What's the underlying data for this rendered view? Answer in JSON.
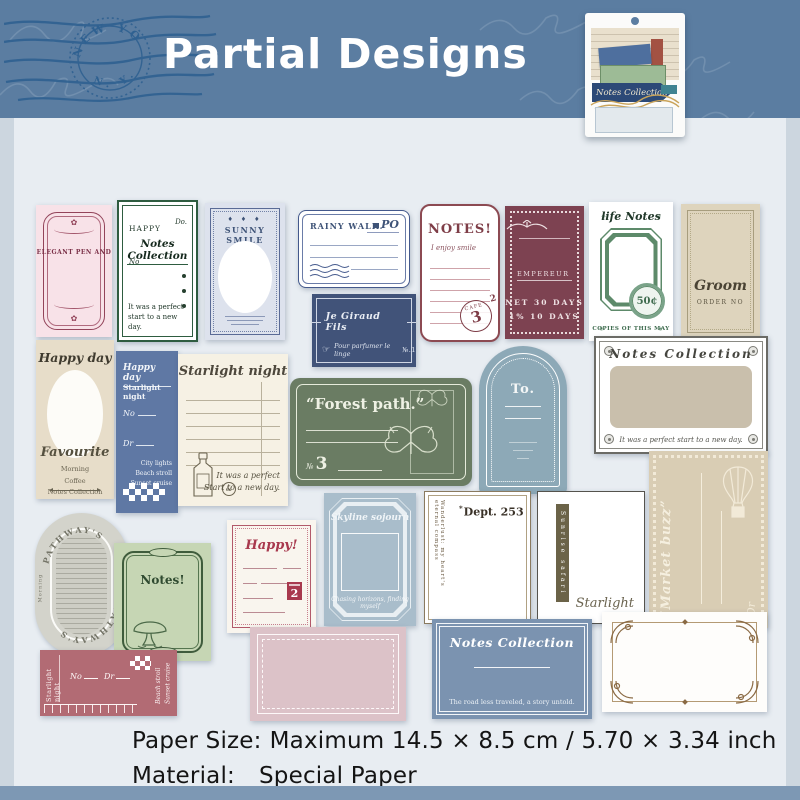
{
  "header": {
    "title": "Partial Designs",
    "postmark": {
      "arc_top": "NEW YO",
      "arc_bottom": "N. Y."
    },
    "package": {
      "label": "Notes Collection"
    }
  },
  "cards": {
    "elegant": {
      "title": "ELEGANT PEN AND"
    },
    "happy_notes": {
      "top_left": "HAPPY",
      "top_right": "Do.",
      "title": "Notes Collection",
      "no_label": "No",
      "footer": "It was a perfect start to a new day."
    },
    "sunny": {
      "diamonds": "♦ ♦ ♦",
      "title": "SUNNY SMILE"
    },
    "rainy": {
      "title": "RAINY WALK.",
      "logo": "PO"
    },
    "giraud": {
      "title": "Je Giraud Fils",
      "hand": "☞",
      "footer": "Pour parfumer le linge",
      "number": "№.1"
    },
    "notes_red": {
      "title": "NOTES!",
      "subtitle": "I enjoy smile",
      "stamp_label": "CAFE",
      "stamp_number": "3",
      "stamp_super": "2"
    },
    "empereur": {
      "label": "EMPEREUR",
      "terms1": "NET 30 DAYS",
      "terms2": "1% 10 DAYS"
    },
    "life_notes": {
      "title": "life Notes",
      "deco": "✳",
      "badge": "50¢",
      "footer": "COPIES OF THIS MAY"
    },
    "groom": {
      "title": "Groom",
      "subtitle": "ORDER NO"
    },
    "happy_day": {
      "title": "Happy day",
      "script": "Favourite",
      "items": [
        "Morning",
        "Coffee",
        "Notes Collection"
      ]
    },
    "blue_happy": {
      "title": "Happy day",
      "subtitle": "Starlight night",
      "no_label": "No",
      "dr_label": "Dr",
      "items": [
        "City lights",
        "Beach stroll",
        "Sunset cruise"
      ]
    },
    "starlight_lines": {
      "title": "Starlight night",
      "amp": "&",
      "footer_line1": "It was a perfect",
      "footer_line2": "Start to a new day."
    },
    "forest": {
      "title": "“Forest path.”",
      "number_label": "№",
      "number": "3"
    },
    "to_arch": {
      "title": "To."
    },
    "notes_frame": {
      "title": "Notes Collection",
      "footer": "It was a perfect start to a new day."
    },
    "market": {
      "title": "“Market buzz”",
      "dr_label": "Dr"
    },
    "skyline": {
      "title": "Skyline sojourn",
      "script": "Chasing horizons, finding myself"
    },
    "dept": {
      "star": "*",
      "title": "Dept. 253",
      "side_text": "Wanderlust: my heart's eternal compass"
    },
    "sunrise": {
      "label": "Sunrise safari",
      "script": "Starlight"
    },
    "pathways": {
      "arc_top": "PATHWAY'S",
      "arc_bottom": "PATHWAY'S",
      "side_left": "Morning",
      "side_right": "Coffee"
    },
    "notes_green": {
      "title": "Notes!"
    },
    "happy2": {
      "title": "Happy!",
      "badge_number": "2"
    },
    "strip": {
      "side_title": "Starlight night",
      "no_label": "No",
      "dr_label": "Dr",
      "script1": "Beach stroll",
      "script2": "Sunset cruise"
    },
    "blue_notes": {
      "title": "Notes Collection",
      "footer": "The road less traveled, a story untold."
    }
  },
  "footer": {
    "paper_size_label": "Paper Size:",
    "paper_size_value": "Maximum 14.5 × 8.5 cm / 5.70 × 3.34 inch",
    "material_label": "Material:",
    "material_value": "Special Paper"
  }
}
